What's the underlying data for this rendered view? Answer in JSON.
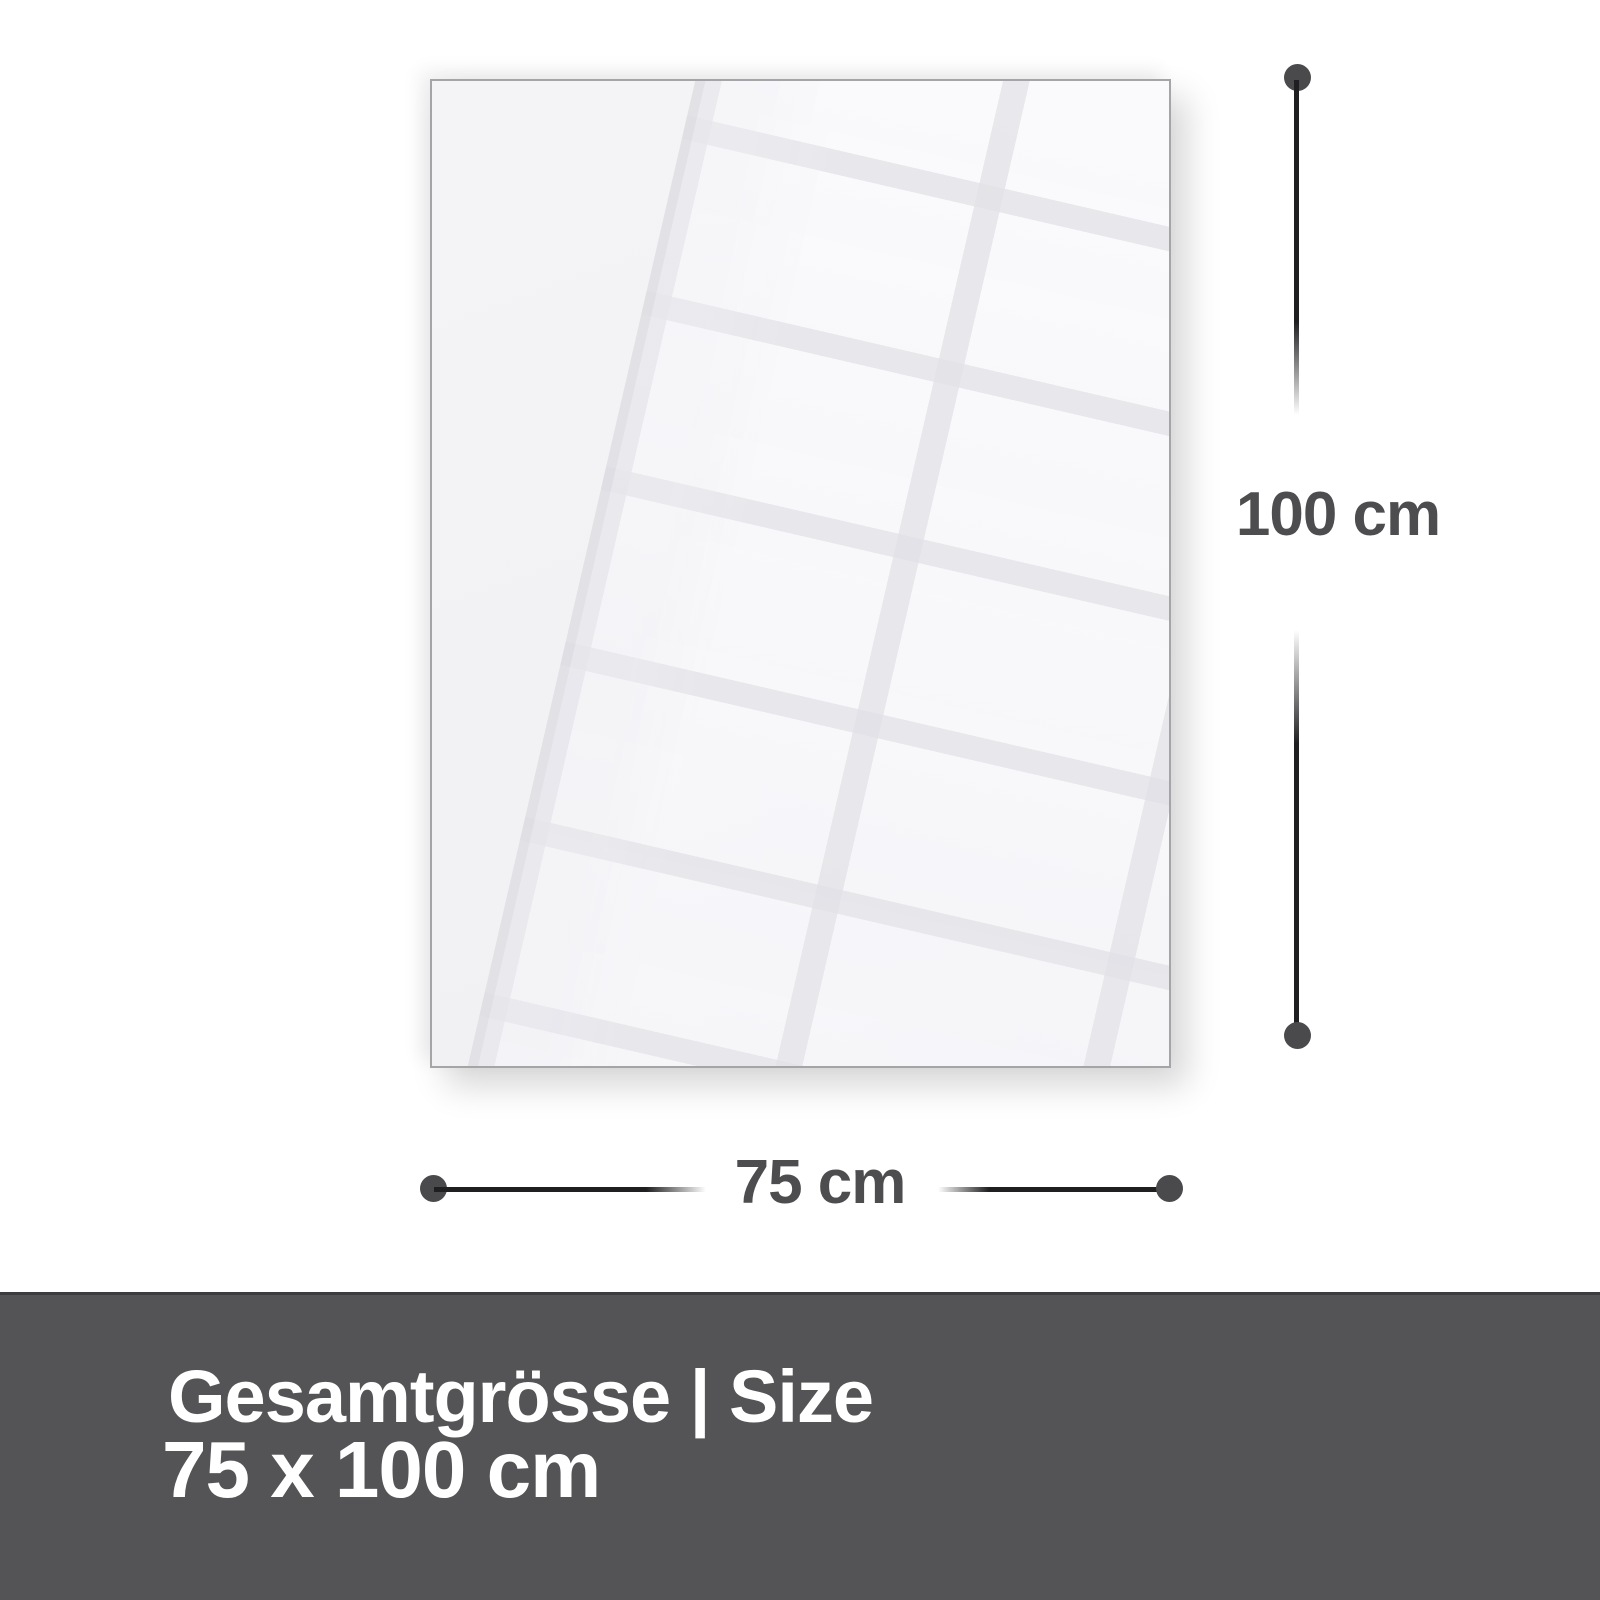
{
  "dimensions": {
    "height": {
      "label": "100 cm"
    },
    "width": {
      "label": "75 cm"
    }
  },
  "footer": {
    "label": "Gesamtgrösse | Size",
    "size": "75 x 100 cm"
  },
  "colors": {
    "page_bg": "#ffffff",
    "panel_fill": "#f3f3f5",
    "panel_border": "#a5a5a7",
    "line": "#1f1f21",
    "dot": "#4a4a4d",
    "dim_label": "#4d4d4f",
    "footer_bg": "#545457",
    "footer_text": "#ffffff"
  }
}
